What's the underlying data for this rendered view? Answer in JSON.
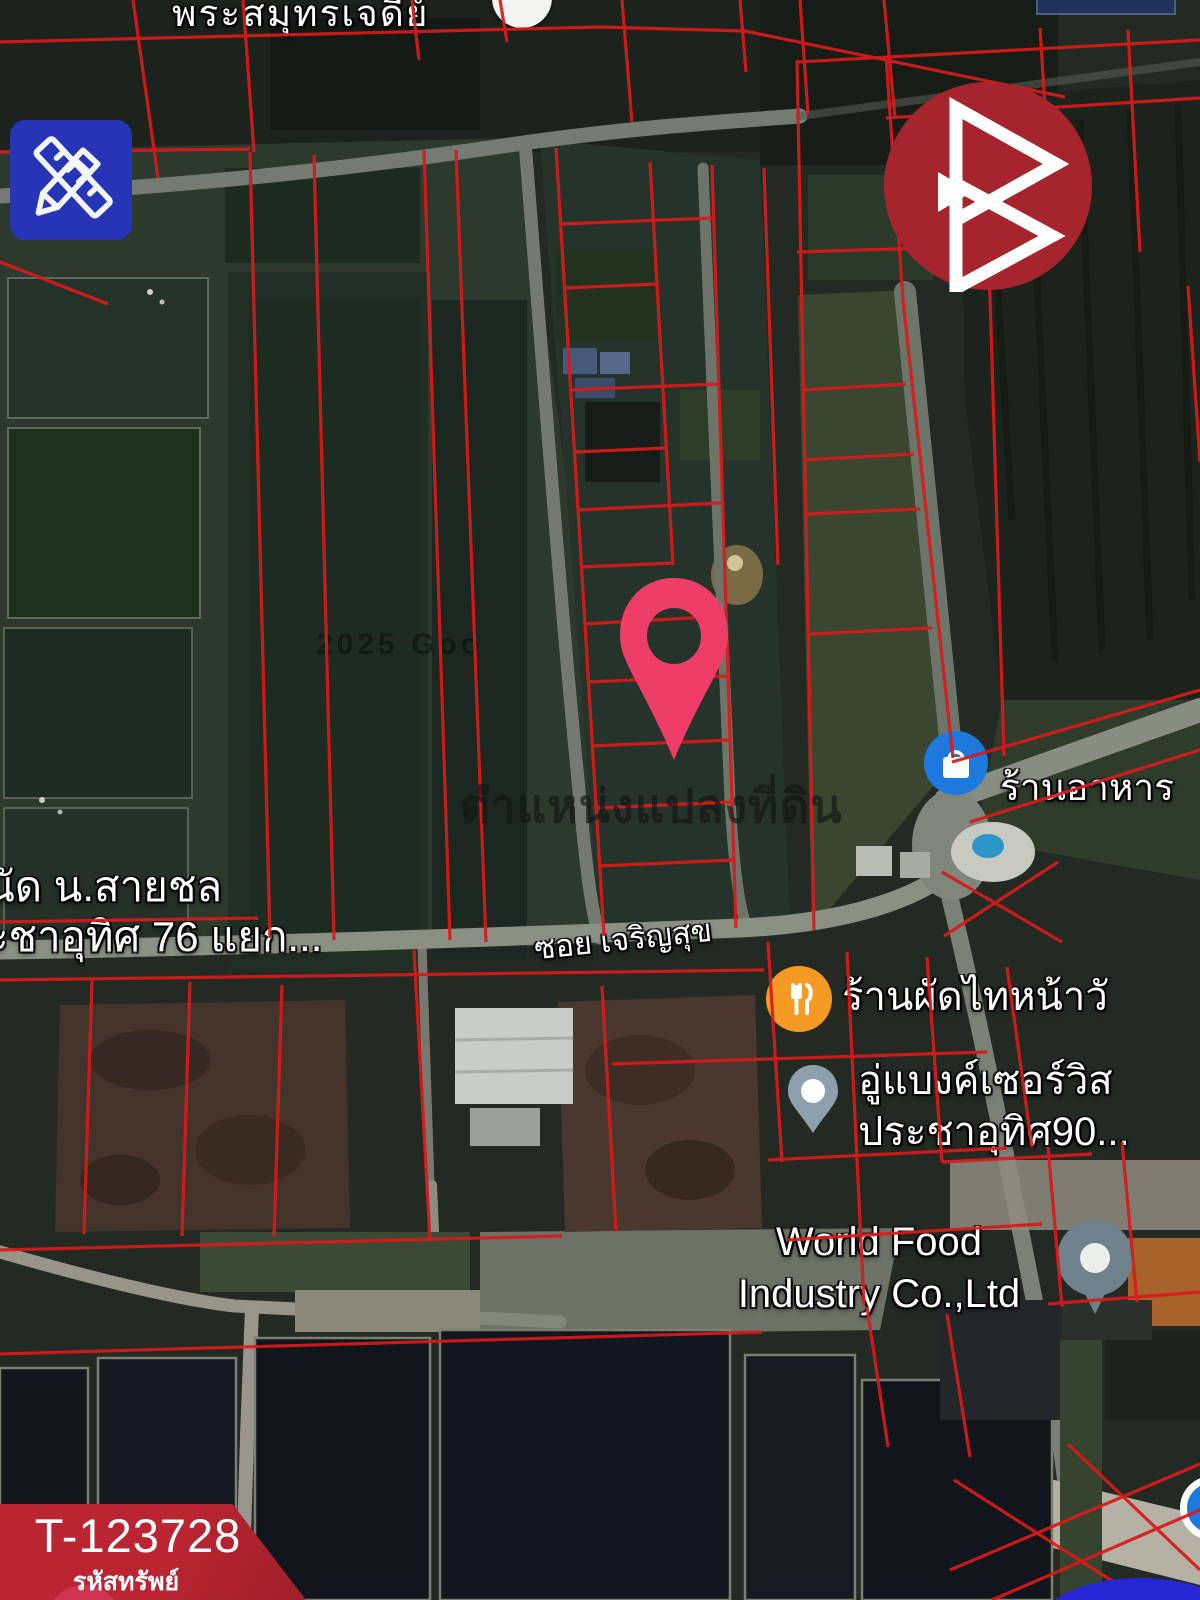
{
  "header": {
    "area_label": "พระสมุทรเจดีย์"
  },
  "watermark": {
    "text": "ตำแหน่งแปลงที่ดิน",
    "copyright": "2025 Goo"
  },
  "annotations": {
    "note_line1": "นัด น.สายชล",
    "note_line2": "ะชาอุทิศ 76 แยก...",
    "road_name": "ซอย เจริญสุข"
  },
  "pois": {
    "restaurant": "ร้านอาหาร",
    "padthai": "ร้านผัดไทหน้าวั",
    "garage_line1": "อู่แบงค์เซอร์วิส",
    "garage_line2": "ประชาอุทิศ90...",
    "worldfood_line1": "World Food",
    "worldfood_line2": "Industry Co.,Ltd"
  },
  "badge": {
    "code": "T-123728",
    "label": "รหัสทรัพย์"
  },
  "icons": {
    "tool_button": "pencil-ruler-icon",
    "brand_logo": "double-triangle-b-logo",
    "property_pin": "location-pin-icon",
    "restaurant_poi": "shopping-bag-icon",
    "padthai_poi": "fork-knife-icon",
    "garage_poi": "map-pin-icon",
    "worldfood_poi": "circle-dot-pin-icon"
  },
  "colors": {
    "parcel_line": "#d81a1a",
    "pin_pink": "#ee3e68",
    "badge_red": "#bb2531",
    "logo_red": "#a6252c",
    "tool_blue": "#2535b6",
    "poi_blue": "#1e79df",
    "poi_orange": "#f59a23"
  }
}
